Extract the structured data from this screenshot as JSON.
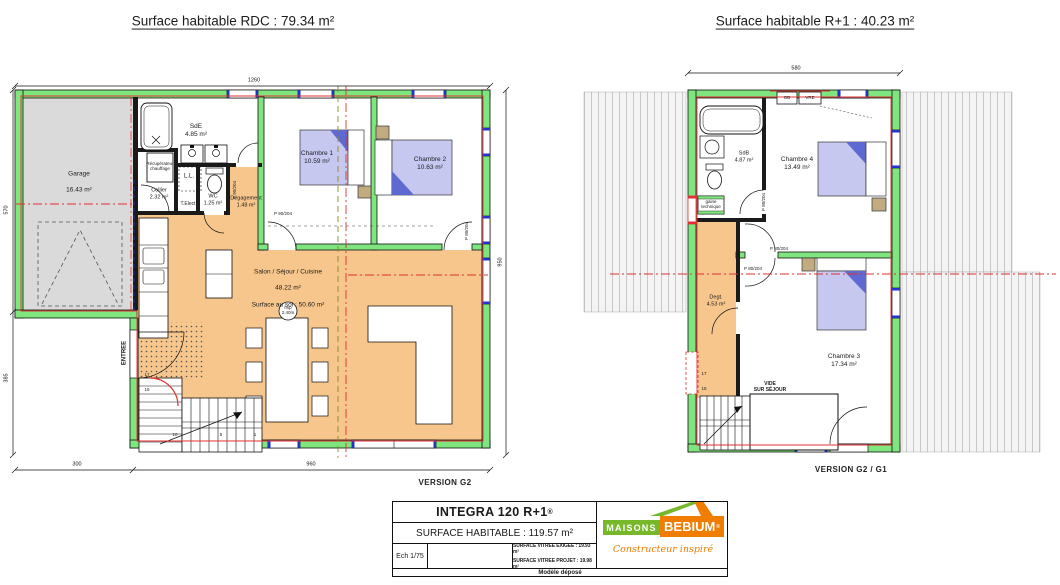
{
  "titles": {
    "rdc": "Surface habitable RDC : 79.34 m²",
    "r1": "Surface habitable R+1 : 40.23 m²"
  },
  "rdc": {
    "version": "VERSION G2",
    "rooms": {
      "garage": {
        "name": "Garage",
        "area": "16.43 m²"
      },
      "sde": {
        "name": "SdE",
        "area": "4.85 m²"
      },
      "cellier": {
        "name": "Cellier",
        "area": "2.32 m²"
      },
      "wc": {
        "name": "WC",
        "area": "1.25 m²"
      },
      "degagement": {
        "name": "Dégagement",
        "area": "1.48 m²"
      },
      "chambre1": {
        "name": "Chambre 1",
        "area": "10.59 m²"
      },
      "chambre2": {
        "name": "Chambre 2",
        "area": "10.63 m²"
      },
      "salon": {
        "name": "Salon / Séjour / Cuisine",
        "area": "48.22 m²",
        "floor": "Surface au sol : 50.60 m²"
      }
    },
    "hsp": "hsp\n2.40m",
    "labels": {
      "entree": "ENTREE",
      "ll": "L.L.",
      "telect": "T.Elect",
      "recup": "Récupérateur\nchauffage",
      "door_p90": "P 90/204",
      "door_p80": "P 80/204"
    },
    "stairs": [
      "17",
      "15",
      "10",
      "5",
      "1"
    ],
    "dims": {
      "top": "1260",
      "bottom_left": "300",
      "bottom_right": "960",
      "left_top": "570",
      "left_bottom": "385",
      "right": "950"
    }
  },
  "r1": {
    "version": "VERSION G2 / G1",
    "rooms": {
      "sdb": {
        "name": "SdB",
        "area": "4.87 m²"
      },
      "chambre4": {
        "name": "Chambre 4",
        "area": "13.49 m²"
      },
      "degt": {
        "name": "Degt.",
        "area": "4.53 m²"
      },
      "chambre3": {
        "name": "Chambre 3",
        "area": "17.34 m²"
      }
    },
    "labels": {
      "ob": "OB",
      "vre": "VRE",
      "gaine": "gaine\ntechnique",
      "vide": "VIDE\nSUR SÉJOUR",
      "door_p80": "P 80/204"
    },
    "stairs": [
      "17",
      "15"
    ],
    "dims": {
      "top": "580"
    }
  },
  "titleblock": {
    "model": "INTEGRA 120 R+1",
    "mark": "®",
    "surface": "SURFACE HABITABLE : 119.57 m²",
    "scale": "Ech 1/75",
    "vitree1": "SURFACE VITREE EXIGEE : 19.93 m²",
    "vitree2": "SURFACE VITREE PROJET : 19.98 m²",
    "deposited": "Modèle déposé",
    "logo": {
      "maisons": "MAISONS",
      "bebium": "BEBIUM",
      "mark": "®",
      "tagline": "Constructeur inspiré"
    }
  },
  "colors": {
    "wall_green": "#7FE57F",
    "floor_orange": "#F6C68C",
    "bed_lavender": "#C6C8F0",
    "bed_blue": "#5E6AD2",
    "garage_grey": "#DADADA",
    "axis_red": "#E03030",
    "logo_green": "#76B82A",
    "logo_orange": "#F07C00"
  }
}
